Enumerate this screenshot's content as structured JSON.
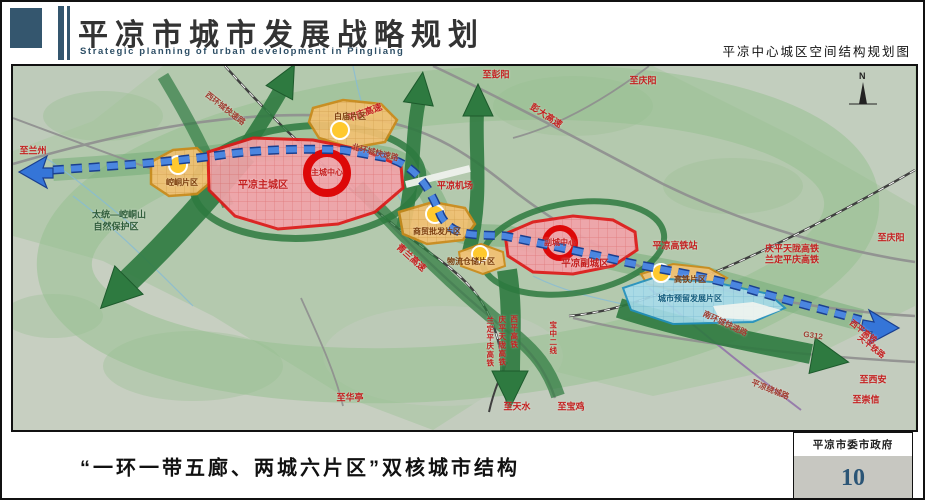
{
  "header": {
    "title": "平凉市城市发展战略规划",
    "subtitle_en": "Strategic planning of urban development in Pingliang",
    "right_caption": "平凉中心城区空间结构规划图"
  },
  "footer": {
    "caption": "“一环一带五廊、两城六片区”双核城市结构",
    "agency": "平凉市委市政府",
    "page_number": "10"
  },
  "map": {
    "north_indicator": "N",
    "label_colors": {
      "red": "#c42020",
      "road": "#a03c30",
      "zone": "#7a3c0c",
      "green": "#2e5c3a",
      "blue": "#135c7d"
    },
    "key_colors": {
      "main_city_fill": "#f2a3aa",
      "city_border": "#e01818",
      "district_fill": "#f2c172",
      "district_border": "#cc8a1a",
      "reserved_fill": "#a8dcec",
      "corridor_green": "#2e7a40",
      "belt_blue": "#3575d8",
      "terrain": "#b4c9ae"
    },
    "labels": [
      {
        "t": "至兰州",
        "x": 20,
        "y": 85,
        "c": "red",
        "fs": 9
      },
      {
        "t": "至彭阳",
        "x": 483,
        "y": 9,
        "c": "red",
        "fs": 9
      },
      {
        "t": "至庆阳",
        "x": 630,
        "y": 15,
        "c": "red",
        "fs": 9
      },
      {
        "t": "彭大高速",
        "x": 533,
        "y": 50,
        "c": "red",
        "fs": 9,
        "rot": 33
      },
      {
        "t": "平庆高速",
        "x": 352,
        "y": 47,
        "c": "red",
        "fs": 9,
        "rot": -20
      },
      {
        "t": "北环城快速路",
        "x": 362,
        "y": 87,
        "c": "road",
        "fs": 8,
        "rot": 14
      },
      {
        "t": "西环城快速路",
        "x": 212,
        "y": 43,
        "c": "road",
        "fs": 8,
        "rot": 38
      },
      {
        "t": "平凉机场",
        "x": 442,
        "y": 120,
        "c": "red",
        "fs": 9
      },
      {
        "t": "青兰高速",
        "x": 398,
        "y": 192,
        "c": "red",
        "fs": 9,
        "rot": 42
      },
      {
        "t": "太统—崆峒山",
        "x": 106,
        "y": 149,
        "c": "green",
        "fs": 9
      },
      {
        "t": "自然保护区",
        "x": 103,
        "y": 161,
        "c": "green",
        "fs": 9
      },
      {
        "t": "平凉主城区",
        "x": 250,
        "y": 120,
        "c": "red",
        "fs": 10
      },
      {
        "t": "主城中心",
        "x": 314,
        "y": 107,
        "c": "red",
        "fs": 8
      },
      {
        "t": "崆峒片区",
        "x": 169,
        "y": 117,
        "c": "zone",
        "fs": 8
      },
      {
        "t": "白庙片区",
        "x": 337,
        "y": 51,
        "c": "zone",
        "fs": 8
      },
      {
        "t": "商贸批发片区",
        "x": 424,
        "y": 166,
        "c": "zone",
        "fs": 8
      },
      {
        "t": "物流仓储片区",
        "x": 458,
        "y": 196,
        "c": "zone",
        "fs": 8
      },
      {
        "t": "副城中心",
        "x": 547,
        "y": 177,
        "c": "red",
        "fs": 8
      },
      {
        "t": "平凉副城区",
        "x": 572,
        "y": 198,
        "c": "red",
        "fs": 9.5
      },
      {
        "t": "平凉高铁站",
        "x": 662,
        "y": 180,
        "c": "red",
        "fs": 9
      },
      {
        "t": "庆平天陇高铁",
        "x": 779,
        "y": 183,
        "c": "red",
        "fs": 9
      },
      {
        "t": "兰定平庆高铁",
        "x": 779,
        "y": 194,
        "c": "red",
        "fs": 9
      },
      {
        "t": "至庆阳",
        "x": 878,
        "y": 172,
        "c": "red",
        "fs": 9
      },
      {
        "t": "高铁片区",
        "x": 677,
        "y": 214,
        "c": "zone",
        "fs": 8
      },
      {
        "t": "城市预留发展片区",
        "x": 677,
        "y": 233,
        "c": "blue",
        "fs": 8
      },
      {
        "t": "南环城快速路",
        "x": 712,
        "y": 258,
        "c": "road",
        "fs": 8,
        "rot": 25
      },
      {
        "t": "G312",
        "x": 800,
        "y": 270,
        "c": "road",
        "fs": 8,
        "rot": 8
      },
      {
        "t": "西平高铁",
        "x": 850,
        "y": 266,
        "c": "red",
        "fs": 8,
        "rot": 38
      },
      {
        "t": "天平铁路",
        "x": 858,
        "y": 281,
        "c": "red",
        "fs": 8,
        "rot": 38
      },
      {
        "t": "至西安",
        "x": 860,
        "y": 314,
        "c": "red",
        "fs": 9
      },
      {
        "t": "至崇信",
        "x": 853,
        "y": 334,
        "c": "red",
        "fs": 9
      },
      {
        "t": "至华亭",
        "x": 337,
        "y": 332,
        "c": "red",
        "fs": 9
      },
      {
        "t": "至天水",
        "x": 504,
        "y": 341,
        "c": "red",
        "fs": 9
      },
      {
        "t": "至宝鸡",
        "x": 558,
        "y": 341,
        "c": "red",
        "fs": 9
      },
      {
        "t": "兰定平庆高铁",
        "x": 477,
        "y": 276,
        "c": "red",
        "fs": 7.5,
        "vert": true
      },
      {
        "t": "庆平天陇高铁",
        "x": 489,
        "y": 275,
        "c": "red",
        "fs": 7.5,
        "vert": true
      },
      {
        "t": "西平高铁",
        "x": 501,
        "y": 266,
        "c": "red",
        "fs": 7.5,
        "vert": true
      },
      {
        "t": "宝中二线",
        "x": 540,
        "y": 272,
        "c": "red",
        "fs": 7.5,
        "vert": true
      },
      {
        "t": "平凉绕城路",
        "x": 757,
        "y": 324,
        "c": "road",
        "fs": 8,
        "rot": 22
      }
    ]
  }
}
